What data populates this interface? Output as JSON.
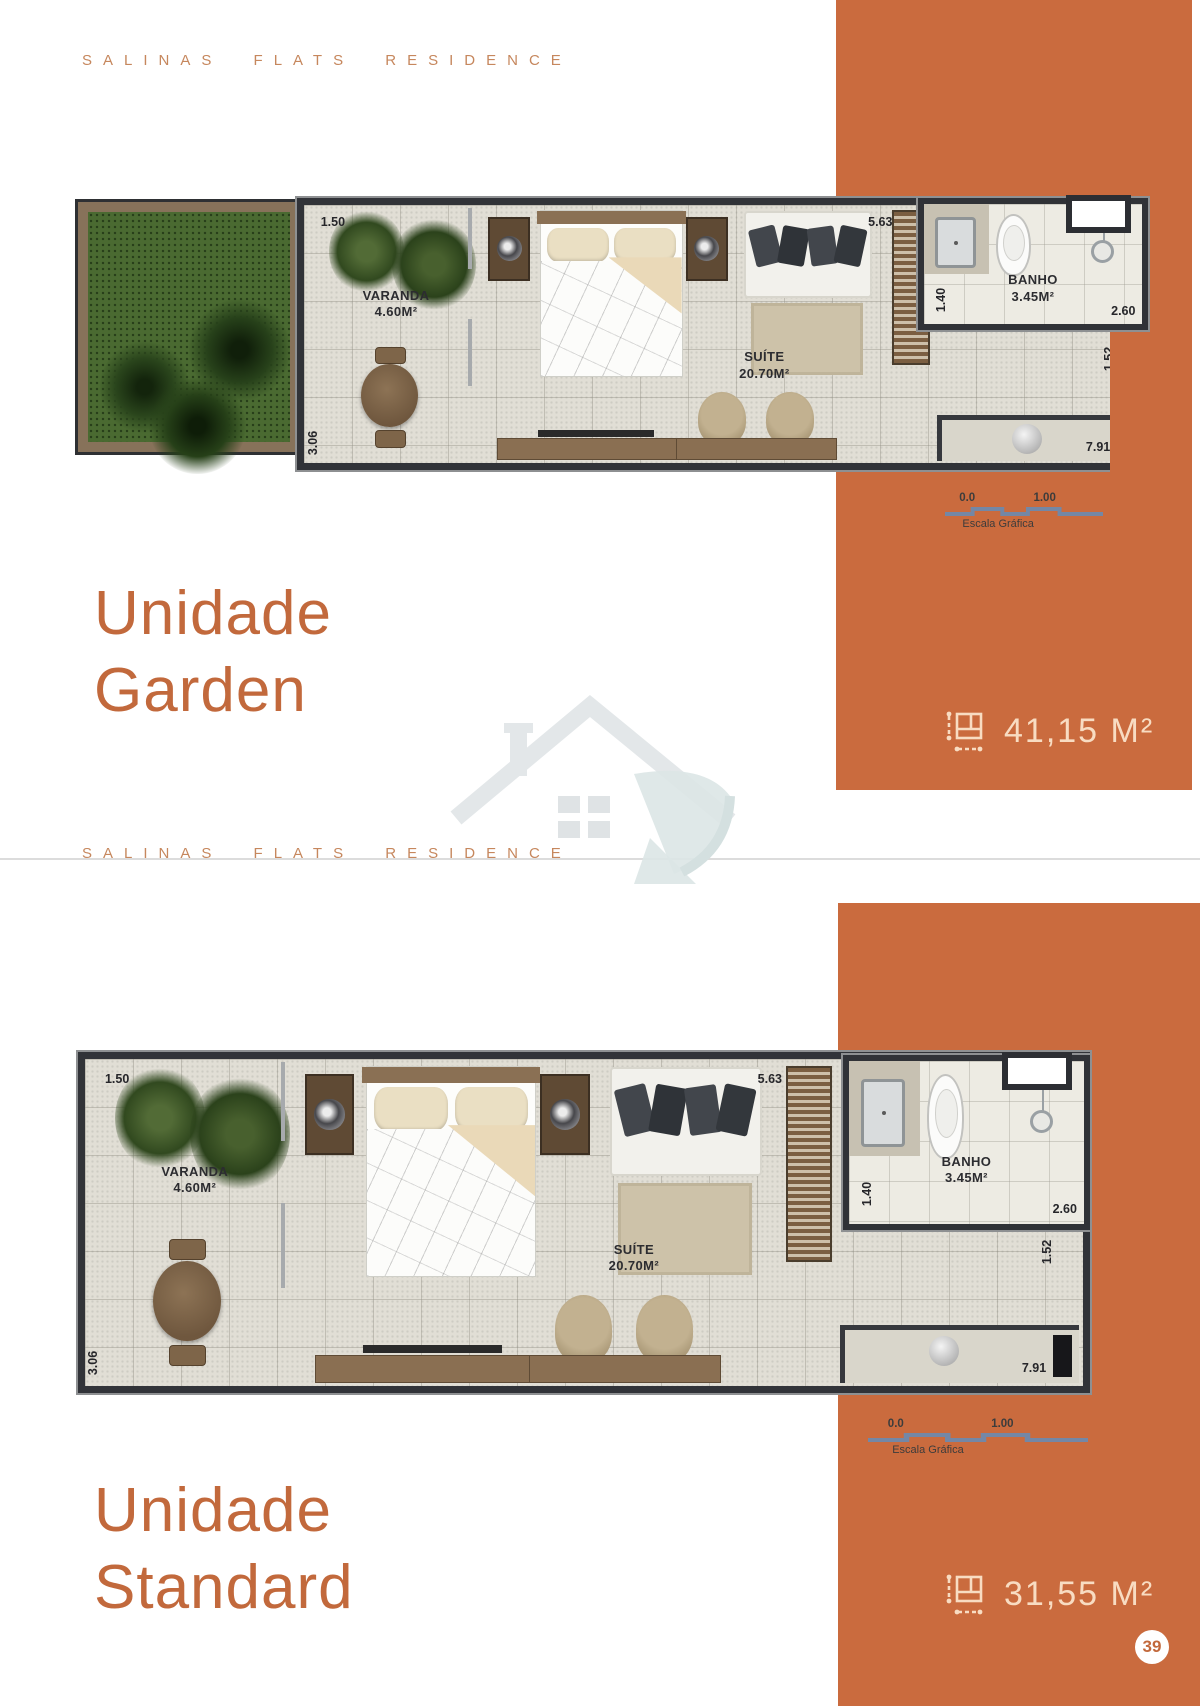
{
  "brand": {
    "text": "SALINAS FLATS RESIDENCE"
  },
  "sections": [
    {
      "title_line1": "Unidade",
      "title_line2": "Garden",
      "area": "41,15 M²"
    },
    {
      "title_line1": "Unidade",
      "title_line2": "Standard",
      "area": "31,55 M²"
    }
  ],
  "plan": {
    "varanda_label": "VARANDA",
    "varanda_area": "4.60M²",
    "suite_label": "SUÍTE",
    "suite_area": "20.70M²",
    "banho_label": "BANHO",
    "banho_area": "3.45M²",
    "dims": {
      "top_left": "1.50",
      "top_right": "5.63",
      "banho_left": "1.40",
      "banho_right": "2.60",
      "hall_right": "1.52",
      "bottom_right": "7.91",
      "bottom_left": "3.06"
    }
  },
  "scale_bar": {
    "start": "0.0",
    "end": "1.00",
    "label": "Escala Gráfica"
  },
  "page": {
    "number": "39"
  },
  "icons": {
    "area_icon": "floor-area-dimensions",
    "watermark": "house-logo"
  },
  "colors": {
    "band_orange": "#ca6b3e",
    "title_orange": "#c2693c",
    "brand_orange": "#c6875d",
    "area_text_cream": "#f8dcc2",
    "scale_line_blue": "#7487a5",
    "wall_dark": "#313338",
    "floor_beige": "#e1ded5",
    "grass_green": "#4a6a31"
  }
}
